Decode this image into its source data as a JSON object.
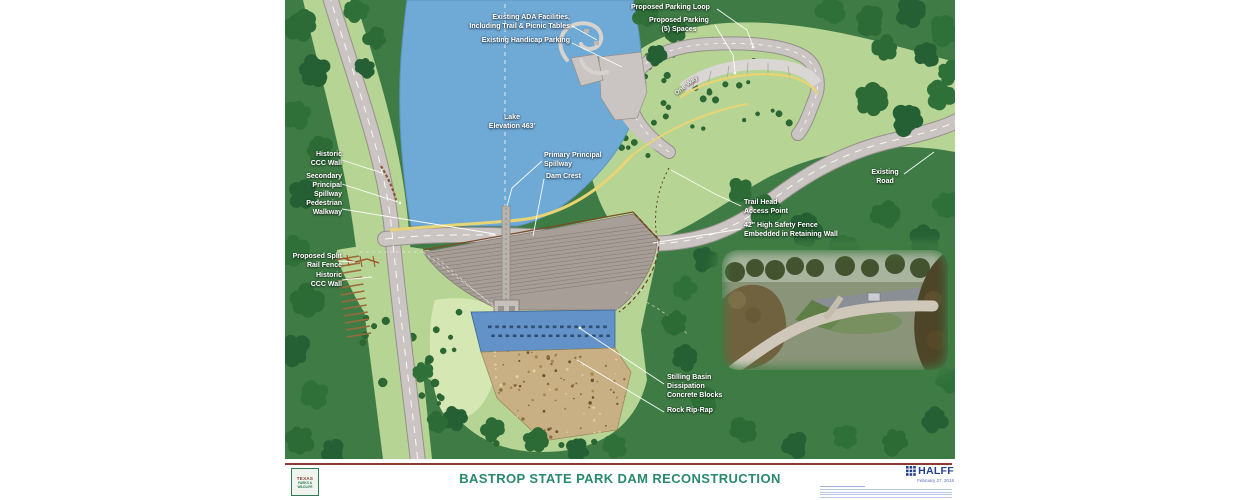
{
  "map": {
    "labels": {
      "ada_facilities": "Existing ADA Facilities,\nIncluding Trail & Picnic Tables",
      "handicap_parking": "Existing Handicap Parking",
      "parking_loop": "Proposed Parking Loop",
      "parking_spaces": "Proposed Parking\n(5) Spaces",
      "one_way": "One Way",
      "lake": "Lake\nElevation 463'",
      "primary_spillway": "Primary Principal\nSpillway",
      "dam_crest": "Dam Crest",
      "historic_ccc_wall_upper": "Historic\nCCC Wall",
      "secondary_spillway": "Secondary\nPrincipal\nSpillway",
      "pedestrian_walkway": "Pedestrian\nWalkway",
      "split_rail_fence": "Proposed Split\nRail Fence",
      "historic_ccc_wall_lower": "Historic\nCCC Wall",
      "trail_head": "Trail Head\nAccess Point",
      "safety_fence": "42\" High Safety Fence\nEmbedded in Retaining Wall",
      "existing_road": "Existing\nRoad",
      "stilling_basin": "Stilling Basin\nDissipation\nConcrete Blocks",
      "rock_rip_rap": "Rock Rip-Rap"
    },
    "colors": {
      "terrain_green": "#3f7c45",
      "light_green": "#b6d494",
      "lake_blue": "#6fa9d6",
      "road_gray": "#cac5c2",
      "trail_yellow": "#e9d474",
      "basin_blue": "#6292c8",
      "riprap_tan": "#c8b084",
      "title_green": "#2a8a68",
      "rule_maroon": "#8a3c34",
      "halff_blue": "#23418e"
    }
  },
  "footer": {
    "title": "BASTROP STATE PARK DAM RECONSTRUCTION",
    "logo": {
      "line1": "TEXAS",
      "line2": "PARKS &",
      "line3": "WILDLIFE"
    },
    "firm": "HALFF",
    "date": "February 27, 2018"
  }
}
